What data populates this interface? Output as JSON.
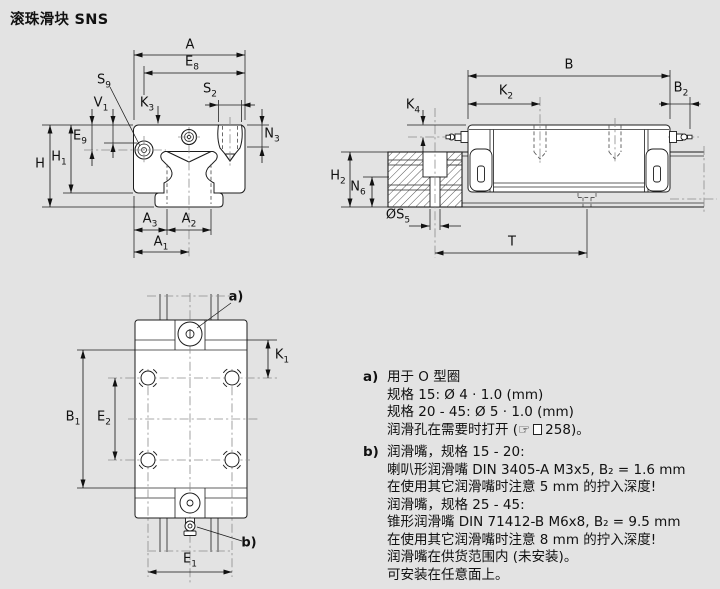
{
  "title": "滚珠滑块 SNS",
  "dims": {
    "front": {
      "A": {
        "t": "A",
        "s": ""
      },
      "E8": {
        "t": "E",
        "s": "8"
      },
      "S9": {
        "t": "S",
        "s": "9"
      },
      "K3": {
        "t": "K",
        "s": "3"
      },
      "S2": {
        "t": "S",
        "s": "2"
      },
      "N3": {
        "t": "N",
        "s": "3"
      },
      "V1": {
        "t": "V",
        "s": "1"
      },
      "E9": {
        "t": "E",
        "s": "9"
      },
      "H": {
        "t": "H",
        "s": ""
      },
      "H1": {
        "t": "H",
        "s": "1"
      },
      "A3": {
        "t": "A",
        "s": "3"
      },
      "A2": {
        "t": "A",
        "s": "2"
      },
      "A1": {
        "t": "A",
        "s": "1"
      }
    },
    "side": {
      "B": {
        "t": "B",
        "s": ""
      },
      "K2": {
        "t": "K",
        "s": "2"
      },
      "B2": {
        "t": "B",
        "s": "2"
      },
      "K4": {
        "t": "K",
        "s": "4"
      },
      "H2": {
        "t": "H",
        "s": "2"
      },
      "N6": {
        "t": "N",
        "s": "6"
      },
      "S5": {
        "t": "ØS",
        "s": "5"
      },
      "T": {
        "t": "T",
        "s": ""
      }
    },
    "top": {
      "a": {
        "t": "a)",
        "s": ""
      },
      "K1": {
        "t": "K",
        "s": "1"
      },
      "B1": {
        "t": "B",
        "s": "1"
      },
      "E2": {
        "t": "E",
        "s": "2"
      },
      "E1": {
        "t": "E",
        "s": "1"
      },
      "b": {
        "t": "b)",
        "s": ""
      }
    }
  },
  "notes": {
    "a": {
      "label": "a)",
      "line1": "用于 O 型圈",
      "line2": "规格 15: Ø 4 · 1.0 (mm)",
      "line3": "规格 20 - 45: Ø 5 · 1.0 (mm)",
      "ref_pre": "润滑孔在需要时打开 (",
      "hand": "☞",
      "ref_post": "258)。"
    },
    "b": {
      "label": "b)",
      "line1": "润滑嘴，规格 15 - 20:",
      "line2": "喇叭形润滑嘴 DIN 3405-A M3x5, B₂ = 1.6 mm",
      "line3": "在使用其它润滑嘴时注意 5 mm 的拧入深度!",
      "line4": "润滑嘴，规格 25 - 45:",
      "line5": "锥形润滑嘴 DIN 71412-B M6x8, B₂ = 9.5 mm",
      "line6": "在使用其它润滑嘴时注意 8 mm 的拧入深度!",
      "line7": "润滑嘴在供货范围内 (未安装)。",
      "line8": "可安装在任意面上。"
    }
  }
}
